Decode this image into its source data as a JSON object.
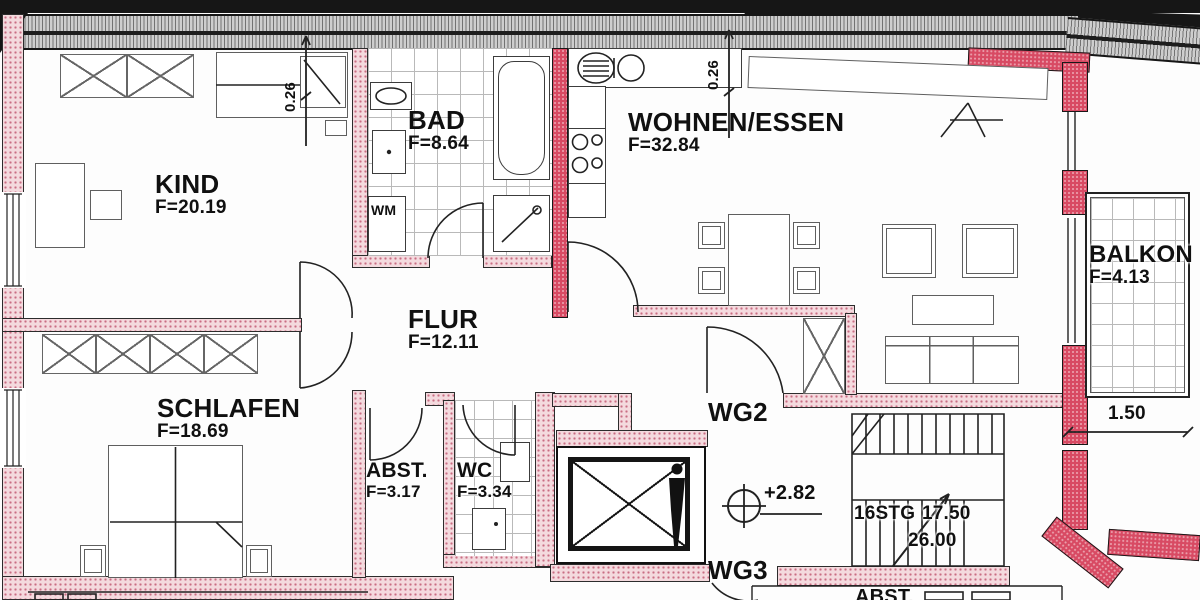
{
  "plan": {
    "rooms": {
      "kind": {
        "name": "KIND",
        "area": "F=20.19"
      },
      "bad": {
        "name": "BAD",
        "area": "F=8.64"
      },
      "wohnen_essen": {
        "name": "WOHNEN/ESSEN",
        "area": "F=32.84"
      },
      "flur": {
        "name": "FLUR",
        "area": "F=12.11"
      },
      "schlafen": {
        "name": "SCHLAFEN",
        "area": "F=18.69"
      },
      "abst": {
        "name": "ABST.",
        "area": "F=3.17"
      },
      "wc": {
        "name": "WC",
        "area": "F=3.34"
      },
      "balkon": {
        "name": "BALKON",
        "area": "F=4.13"
      },
      "abst_neighbor": {
        "name": "ABST."
      }
    },
    "halls": {
      "wg2": "WG2",
      "wg3": "WG3"
    },
    "appliances": {
      "washing_machine": "WM"
    },
    "levels": {
      "story_level": "+2.82"
    },
    "stairs": {
      "label_steps": "16STG",
      "label_rise": "17.50",
      "label_run": "26.00"
    },
    "dimensions": {
      "wall_left": "0.26",
      "wall_right": "0.26",
      "balcony_width": "1.50"
    },
    "colors": {
      "new_wall_red": "#d84a63",
      "wall_hatch_pink": "#f4dade",
      "wall_dot_pink": "#c96d83",
      "exterior_hatch_gray": "#c6c6c6",
      "line": "#1c1c1c"
    }
  }
}
